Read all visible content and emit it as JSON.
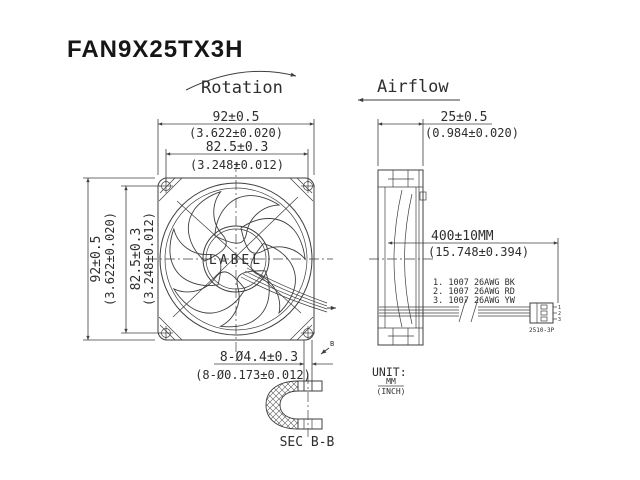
{
  "title": "FAN9X25TX3H",
  "labels": {
    "rotation": "Rotation",
    "airflow": "Airflow"
  },
  "front_view": {
    "top": {
      "mm": "92±0.5",
      "inch": "(3.622±0.020)"
    },
    "top_holes": {
      "mm": "82.5±0.3",
      "inch": "(3.248±0.012)"
    },
    "left": {
      "mm": "92±0.5",
      "inch": "(3.622±0.020)"
    },
    "left_holes": {
      "mm": "82.5±0.3",
      "inch": "(3.248±0.012)"
    },
    "hub_label": "LABEL",
    "holes_callout": {
      "mm": "8-Ø4.4±0.3",
      "inch": "(8-Ø0.173±0.012)"
    },
    "section_marker": "B"
  },
  "section_view": {
    "label": "SEC B-B"
  },
  "side_view": {
    "depth": {
      "mm": "25±0.5",
      "inch": "(0.984±0.020)"
    }
  },
  "cable": {
    "length": {
      "mm": "400±10MM",
      "inch": "(15.748±0.394)"
    },
    "wires": [
      "1. 1007 26AWG BK",
      "2. 1007 26AWG RD",
      "3. 1007 26AWG YW"
    ],
    "connector": "2510-3P",
    "pins": [
      "1",
      "2",
      "3"
    ]
  },
  "units": {
    "label": "UNIT:",
    "numerator": "MM",
    "denominator": "(INCH)"
  },
  "colors": {
    "background": "#ffffff",
    "line": "#3f3f3f",
    "text": "#2e2e2e"
  }
}
